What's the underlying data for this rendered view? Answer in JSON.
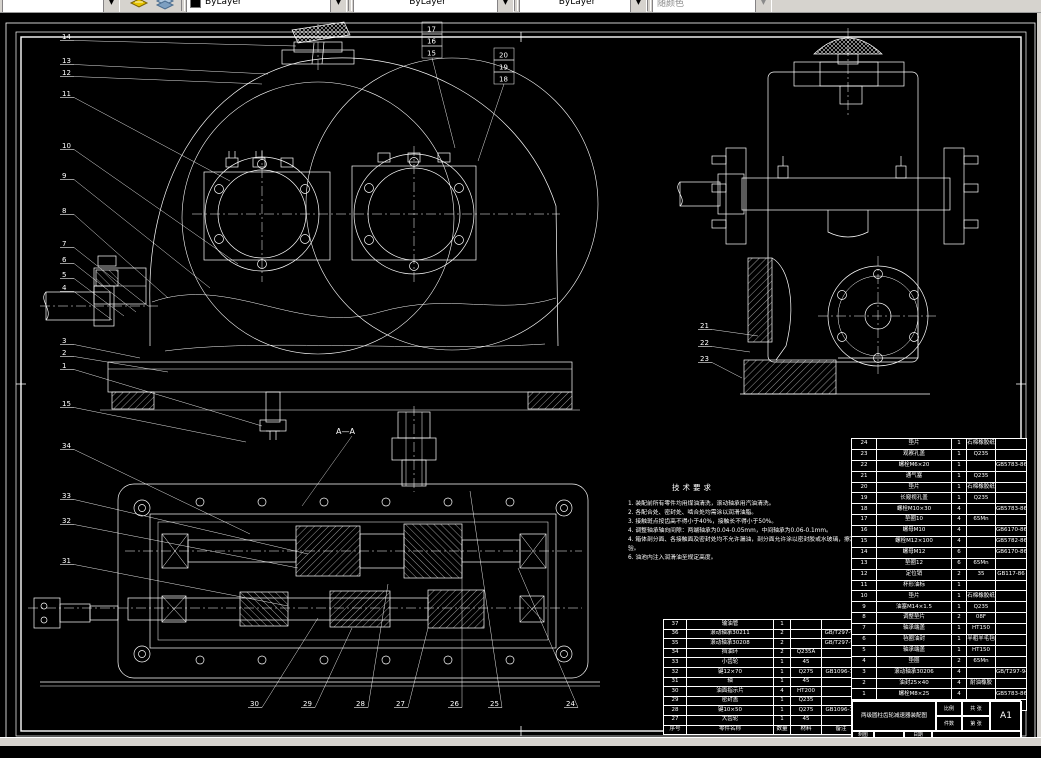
{
  "toolbar": {
    "layer_combo_value": "",
    "color_value": "ByLayer",
    "linetype_value": "ByLayer",
    "lineweight_value": "ByLayer",
    "plotstyle_value": "随颜色",
    "arrow_glyph": "▼"
  },
  "drawing": {
    "section_label": "A—A",
    "tech_requirements": {
      "title": "技术要求",
      "lines": [
        "1. 装配前所有零件均用煤油清洗，滚动轴承用汽油清洗。",
        "2. 各配合处、密封处、啮合处均需涂以润滑油脂。",
        "3. 接触斑点按齿高不得小于40%，接触长不得小于50%。",
        "4. 调整轴承轴向间隙：两端轴承为0.04-0.05mm，中间轴承为0.06-0.1mm。",
        "4. 箱体剖分面、各接触面及密封处均不允许漏油，剖分面允许涂以密封胶或水玻璃，擦净后涂色检验。",
        "6. 油池内注入润滑油至规定高度。"
      ]
    },
    "bom_header": [
      "序号",
      "零件名称",
      "数量",
      "材料",
      "备注"
    ],
    "bom_left_rows": [
      [
        "37",
        "输油管",
        "1",
        "",
        ""
      ],
      [
        "36",
        "滚动轴承30211",
        "2",
        "",
        "GB/T297-94"
      ],
      [
        "35",
        "滚动轴承30208",
        "2",
        "",
        "GB/T297-94"
      ],
      [
        "34",
        "挡油环",
        "2",
        "Q235A",
        ""
      ],
      [
        "33",
        "小齿轮",
        "1",
        "45",
        ""
      ],
      [
        "32",
        "键12×70",
        "1",
        "Q275",
        "GB1096-79"
      ],
      [
        "31",
        "轴",
        "1",
        "45",
        ""
      ],
      [
        "30",
        "油面指示片",
        "4",
        "HT200",
        ""
      ],
      [
        "29",
        "密封盖",
        "1",
        "Q235",
        ""
      ],
      [
        "28",
        "键10×50",
        "1",
        "Q275",
        "GB1096-79"
      ],
      [
        "27",
        "大齿轮",
        "1",
        "45",
        ""
      ]
    ],
    "bom_right_rows": [
      [
        "24",
        "垫片",
        "1",
        "石棉橡胶纸",
        ""
      ],
      [
        "23",
        "观察孔盖",
        "1",
        "Q235",
        ""
      ],
      [
        "22",
        "螺栓M6×20",
        "1",
        "",
        "GB5783-86"
      ],
      [
        "21",
        "通气塞",
        "1",
        "Q235",
        ""
      ],
      [
        "20",
        "垫片",
        "1",
        "石棉橡胶纸",
        ""
      ],
      [
        "19",
        "长窥视孔盖",
        "1",
        "Q235",
        ""
      ],
      [
        "18",
        "螺栓M10×30",
        "4",
        "",
        "GB5783-86"
      ],
      [
        "17",
        "垫圈10",
        "4",
        "65Mn",
        ""
      ],
      [
        "16",
        "螺母M10",
        "4",
        "",
        "GB6170-86"
      ],
      [
        "15",
        "螺栓M12×100",
        "4",
        "",
        "GB5782-86"
      ],
      [
        "14",
        "螺母M12",
        "6",
        "",
        "GB6170-86"
      ],
      [
        "13",
        "垫圈12",
        "6",
        "65Mn",
        ""
      ],
      [
        "12",
        "定位销",
        "2",
        "35",
        "GB117-86"
      ],
      [
        "11",
        "杯形油标",
        "1",
        "",
        ""
      ],
      [
        "10",
        "垫片",
        "1",
        "石棉橡胶纸",
        ""
      ],
      [
        "9",
        "油塞M14×1.5",
        "1",
        "Q235",
        ""
      ],
      [
        "8",
        "调整垫片",
        "2",
        "08F",
        ""
      ],
      [
        "7",
        "轴承端盖",
        "1",
        "HT150",
        ""
      ],
      [
        "6",
        "毡圈油封",
        "1",
        "半粗羊毛毡",
        ""
      ],
      [
        "5",
        "轴承端盖",
        "1",
        "HT150",
        ""
      ],
      [
        "4",
        "垫圈",
        "2",
        "65Mn",
        ""
      ],
      [
        "3",
        "滚动轴承30206",
        "4",
        "",
        "GB/T297-94"
      ],
      [
        "2",
        "油封25×40",
        "4",
        "耐油橡胶",
        ""
      ],
      [
        "1",
        "螺栓M8×25",
        "4",
        "",
        "GB5783-86"
      ]
    ],
    "title_block": {
      "title": "两级圆柱齿轮减速器装配图",
      "scale_label": "比例",
      "qty_label": "件数",
      "sheet_total_label": "共 张",
      "sheet_no_label": "第 张",
      "sheet_size": "A1",
      "drawn_label": "制图",
      "checked_label": "校核",
      "date_label1": "日期",
      "date_label2": "日期"
    },
    "balloons": [
      {
        "n": "14",
        "x": 62,
        "y": 33,
        "tx": 296,
        "ty": 40
      },
      {
        "n": "13",
        "x": 62,
        "y": 57,
        "tx": 268,
        "ty": 68
      },
      {
        "n": "12",
        "x": 62,
        "y": 69,
        "tx": 262,
        "ty": 78
      },
      {
        "n": "11",
        "x": 62,
        "y": 90,
        "tx": 230,
        "ty": 175
      },
      {
        "n": "10",
        "x": 62,
        "y": 142,
        "tx": 238,
        "ty": 258
      },
      {
        "n": "9",
        "x": 62,
        "y": 172,
        "tx": 210,
        "ty": 282
      },
      {
        "n": "8",
        "x": 62,
        "y": 207,
        "tx": 168,
        "ty": 292
      },
      {
        "n": "7",
        "x": 62,
        "y": 240,
        "tx": 148,
        "ty": 300
      },
      {
        "n": "6",
        "x": 62,
        "y": 256,
        "tx": 136,
        "ty": 306
      },
      {
        "n": "5",
        "x": 62,
        "y": 271,
        "tx": 124,
        "ty": 310
      },
      {
        "n": "4",
        "x": 62,
        "y": 284,
        "tx": 112,
        "ty": 314
      },
      {
        "n": "3",
        "x": 62,
        "y": 337,
        "tx": 140,
        "ty": 352
      },
      {
        "n": "2",
        "x": 62,
        "y": 349,
        "tx": 168,
        "ty": 366
      },
      {
        "n": "1",
        "x": 62,
        "y": 362,
        "tx": 262,
        "ty": 420
      },
      {
        "n": "15",
        "x": 62,
        "y": 400,
        "tx": 246,
        "ty": 436
      },
      {
        "n": "34",
        "x": 62,
        "y": 442,
        "tx": 250,
        "ty": 528
      },
      {
        "n": "33",
        "x": 62,
        "y": 492,
        "tx": 308,
        "ty": 548
      },
      {
        "n": "32",
        "x": 62,
        "y": 517,
        "tx": 298,
        "ty": 562
      },
      {
        "n": "31",
        "x": 62,
        "y": 557,
        "tx": 288,
        "ty": 600
      },
      {
        "n": "21",
        "x": 700,
        "y": 322,
        "tx": 758,
        "ty": 330
      },
      {
        "n": "22",
        "x": 700,
        "y": 339,
        "tx": 750,
        "ty": 346
      },
      {
        "n": "23",
        "x": 700,
        "y": 355,
        "tx": 742,
        "ty": 372
      },
      {
        "n": "30",
        "x": 250,
        "y": 700,
        "tx": 318,
        "ty": 612
      },
      {
        "n": "29",
        "x": 303,
        "y": 700,
        "tx": 352,
        "ty": 622
      },
      {
        "n": "28",
        "x": 356,
        "y": 700,
        "tx": 388,
        "ty": 578
      },
      {
        "n": "27",
        "x": 396,
        "y": 700,
        "tx": 428,
        "ty": 622
      },
      {
        "n": "26",
        "x": 450,
        "y": 700,
        "tx": 462,
        "ty": 556
      },
      {
        "n": "25",
        "x": 490,
        "y": 700,
        "tx": 470,
        "ty": 485
      },
      {
        "n": "24",
        "x": 566,
        "y": 700,
        "tx": 518,
        "ty": 562
      }
    ],
    "balloon_stacks": [
      {
        "x": 424,
        "y": 24,
        "items": [
          "17",
          "16",
          "15"
        ],
        "tx": 455,
        "ty": 142
      },
      {
        "x": 496,
        "y": 50,
        "items": [
          "20",
          "19",
          "18"
        ],
        "tx": 478,
        "ty": 155
      }
    ]
  }
}
